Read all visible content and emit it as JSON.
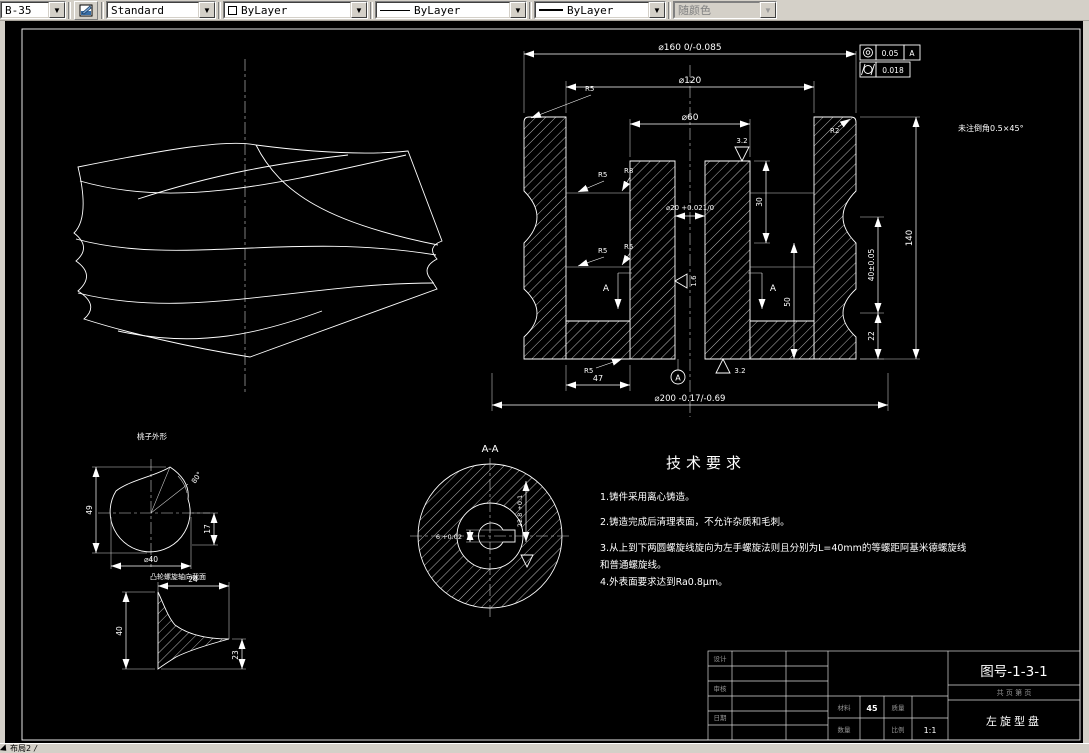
{
  "toolbar": {
    "layer": "B-35",
    "text_style": "Standard",
    "color": "ByLayer",
    "linetype": "ByLayer",
    "lineweight": "ByLayer",
    "plot_style": "随颜色"
  },
  "statusbar": {
    "layout_tab": "布局2",
    "slash": "/"
  },
  "drawing": {
    "notes": {
      "title": "技术要求",
      "items": [
        "1.铸件采用离心铸造。",
        "2.铸造完成后清理表面，不允许杂质和毛刺。",
        "3.从上到下两圆螺旋线旋向为左手螺旋法则且分别为L=40mm的等螺距阿基米德螺旋线",
        "和普通螺旋线。",
        "4.外表面要求达到Ra0.8μm。"
      ]
    },
    "chamfer_note": "未注倒角0.5×45°",
    "gdt": {
      "tol_runout": "0.05",
      "datum": "A",
      "tol_cyl": "0.018"
    },
    "dims": {
      "d160": "⌀160 0/-0.085",
      "d120": "⌀120",
      "d60": "⌀60",
      "d20": "⌀20 +0.021/0",
      "d200": "⌀200 -0.17/-0.69",
      "v30": "30",
      "v50": "50",
      "v40": "40±0.05",
      "v22": "22",
      "v140": "140",
      "v47": "47",
      "r5": "R5",
      "r8": "R8",
      "r2": "R2",
      "f32": "3.2",
      "f16": "1.6"
    },
    "section": {
      "arrow_label": "A",
      "view_label": "A-A",
      "datum_label": "A",
      "slot_width": "6 +0.02",
      "slot_depth": "22.8 +0.1"
    },
    "cam_view": {
      "title": "桃子外形",
      "height": "49",
      "angle": "80°",
      "offset": "17",
      "dia": "⌀40"
    },
    "spiral_view": {
      "title": "凸轮螺旋轴向截面",
      "width": "24",
      "height": "40",
      "depth": "23"
    }
  },
  "titleblock": {
    "drawing_no": "图号-1-3-1",
    "part_name": "左旋型盘",
    "sheet_info": "共    页  第    页",
    "design_label": "设计",
    "check_label": "审核",
    "date_label": "日期",
    "material_label": "材料",
    "material_value": "45",
    "mass_label": "质量",
    "qty_label": "数量",
    "scale_label": "比例",
    "scale_value": "1:1"
  }
}
